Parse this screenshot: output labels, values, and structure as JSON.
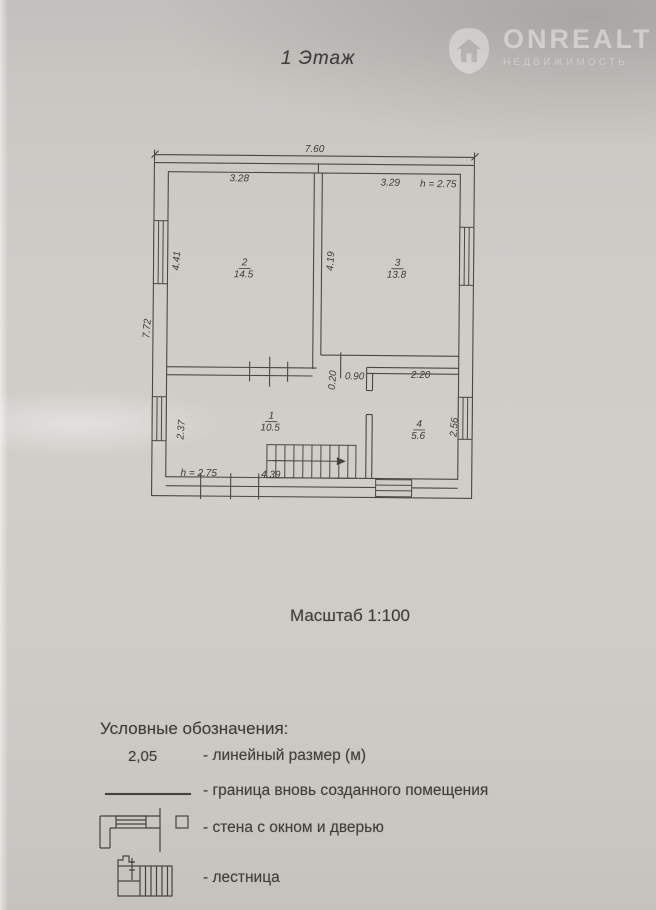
{
  "title": "1 Этаж",
  "scale_label": "Масштаб 1:100",
  "watermark": {
    "brand": "ONREALT",
    "subtitle": "НЕДВИЖИМОСТЬ"
  },
  "plan": {
    "dimensions": {
      "overall_width": "7.60",
      "outer_left_height": "7.72",
      "room2_width": "3.28",
      "room3_width": "3.29",
      "ceiling_height_top": "h = 2.75",
      "room2_height": "4.41",
      "partition_height": "4.19",
      "wall_jog": "0.20",
      "opening_width": "0.90",
      "room4_width": "2.20",
      "room1_height": "2.37",
      "room4_height": "2.56",
      "ceiling_height_bottom": "h = 2.75",
      "stairs_width": "4.39"
    },
    "rooms": [
      {
        "number": "2",
        "area": "14.5"
      },
      {
        "number": "3",
        "area": "13.8"
      },
      {
        "number": "1",
        "area": "10.5"
      },
      {
        "number": "4",
        "area": "5.6"
      }
    ]
  },
  "legend": {
    "heading": "Условные обозначения:",
    "items": [
      {
        "symbol_text": "2,05",
        "label": "- линейный размер (м)"
      },
      {
        "label": "- граница вновь созданного помещения"
      },
      {
        "label": "- стена с окном и дверью"
      },
      {
        "label": "- лестница"
      }
    ]
  },
  "colors": {
    "paper": "#cdcac6",
    "ink": "#45423e",
    "watermark": "#ffffff"
  }
}
